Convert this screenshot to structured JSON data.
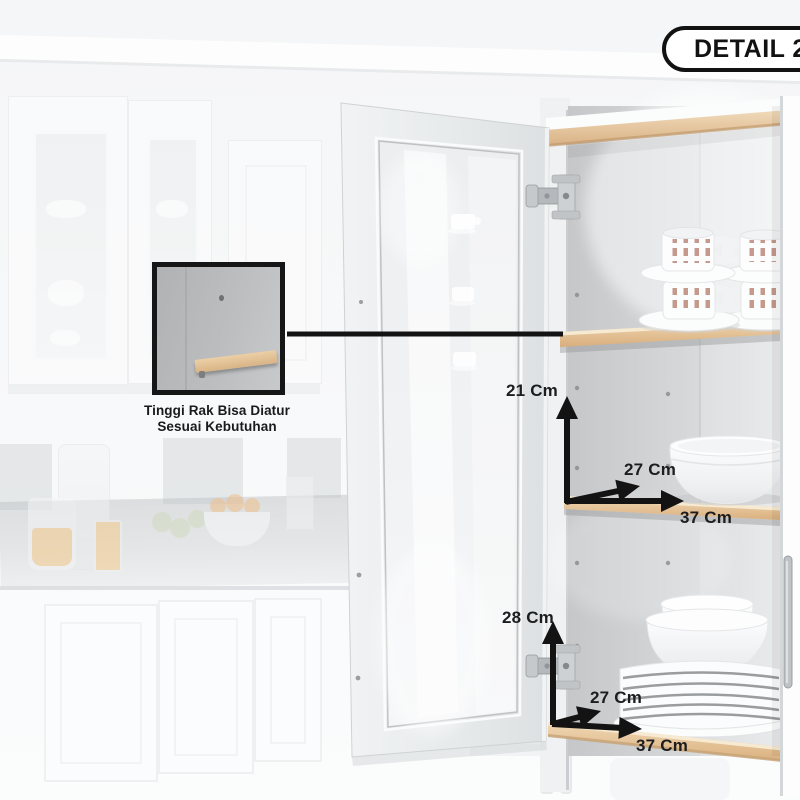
{
  "badge": {
    "label": "DETAIL 2"
  },
  "inset": {
    "caption": [
      "Tinggi Rak Bisa Diatur",
      "Sesuai Kebutuhan"
    ]
  },
  "dimensions": {
    "middle": {
      "height": "21 Cm",
      "depth": "27 Cm",
      "width": "37 Cm"
    },
    "bottom": {
      "height": "28 Cm",
      "depth": "27 Cm",
      "width": "37 Cm"
    }
  },
  "colors": {
    "annotation_black": "#131313",
    "badge_border": "#121212",
    "badge_background": "#ffffff",
    "wood_shelf": "#e2bd8e",
    "interior_wall": "#cdd0d2",
    "caption_text": "#191a1b"
  }
}
